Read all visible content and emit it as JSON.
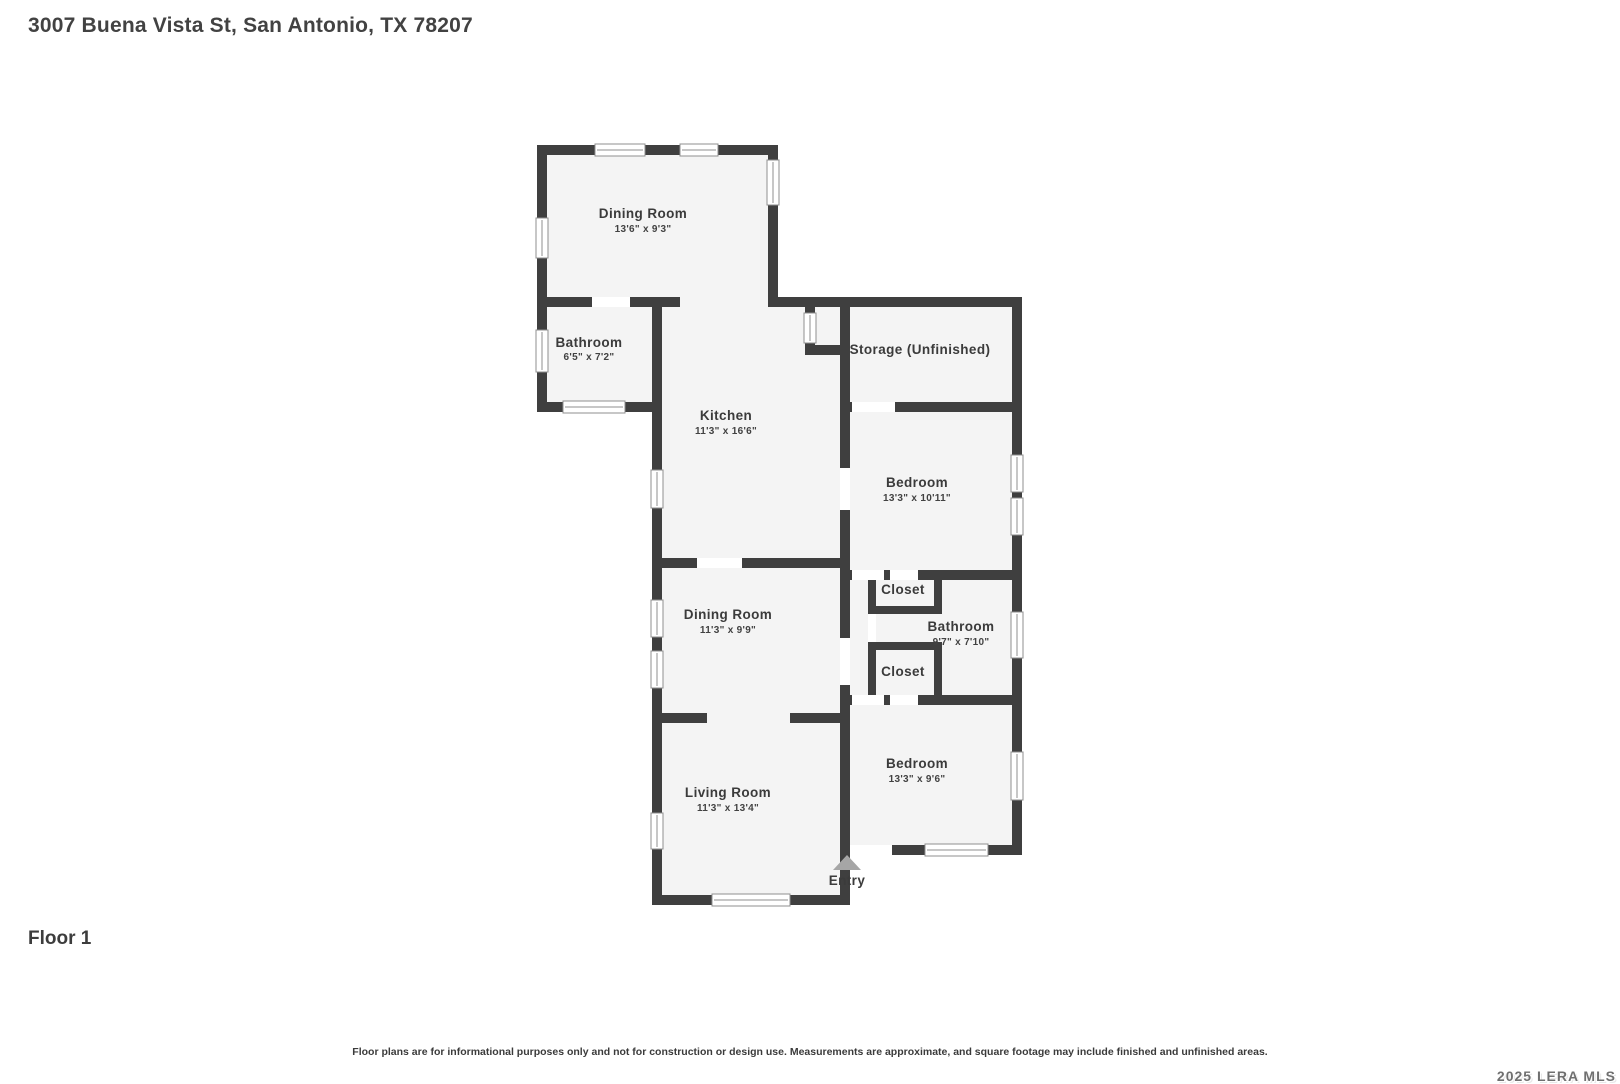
{
  "header": {
    "title": "3007 Buena Vista St, San Antonio, TX 78207"
  },
  "floor_label": "Floor 1",
  "disclaimer": "Floor plans are for informational purposes only and not for construction or design use. Measurements are approximate, and square footage may include finished and unfinished areas.",
  "watermark": "2025 LERA MLS",
  "colors": {
    "wall": "#3f3f3f",
    "room_fill": "#f4f4f4",
    "door": "#ffffff",
    "label": "#3b3b3b",
    "entry_arrow": "#a6a6a6"
  },
  "rooms": {
    "dining_top": {
      "name": "Dining Room",
      "dims": "13'6\" x 9'3\""
    },
    "bathroom_top": {
      "name": "Bathroom",
      "dims": "6'5\" x 7'2\""
    },
    "kitchen": {
      "name": "Kitchen",
      "dims": "11'3\" x 16'6\""
    },
    "storage": {
      "name": "Storage (Unfinished)",
      "dims": ""
    },
    "bedroom_top": {
      "name": "Bedroom",
      "dims": "13'3\" x 10'11\""
    },
    "dining_mid": {
      "name": "Dining Room",
      "dims": "11'3\" x 9'9\""
    },
    "closet_top": {
      "name": "Closet",
      "dims": ""
    },
    "bathroom_mid": {
      "name": "Bathroom",
      "dims": "9'7\" x 7'10\""
    },
    "closet_bottom": {
      "name": "Closet",
      "dims": ""
    },
    "bedroom_bottom": {
      "name": "Bedroom",
      "dims": "13'3\" x 9'6\""
    },
    "living": {
      "name": "Living Room",
      "dims": "11'3\" x 13'4\""
    },
    "entry": {
      "name": "Entry",
      "dims": ""
    }
  }
}
